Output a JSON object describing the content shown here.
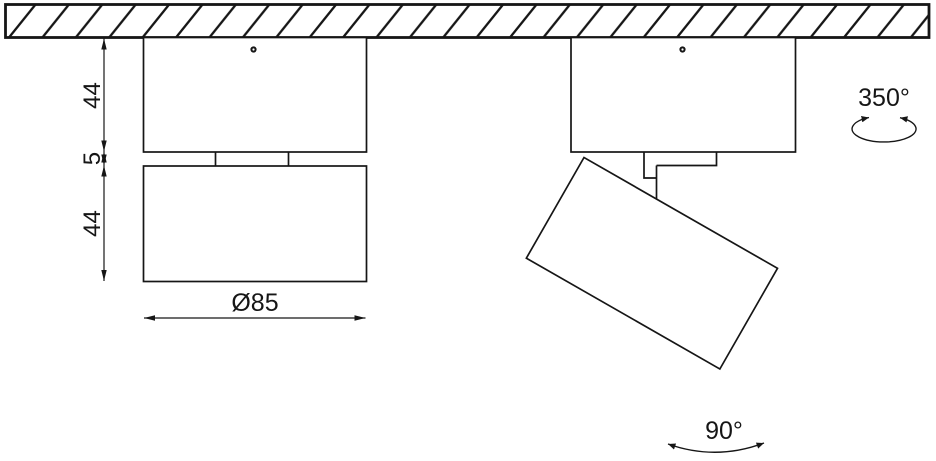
{
  "drawing": {
    "colors": {
      "background": "#ffffff",
      "line": "#161616"
    },
    "labels": {
      "base_height": "44",
      "gap_height": "5",
      "head_height": "44",
      "diameter": "Ø85",
      "pan_rotation": "350°",
      "tilt_rotation": "90°"
    },
    "icons": {
      "ceiling": "diagonal-hatch-band",
      "screw": "screw-dot",
      "pan_symbol": "ellipse-rotation-arrow",
      "tilt_symbol": "arc-rotation-arrow",
      "dimension_terminator": "arrowhead"
    }
  }
}
